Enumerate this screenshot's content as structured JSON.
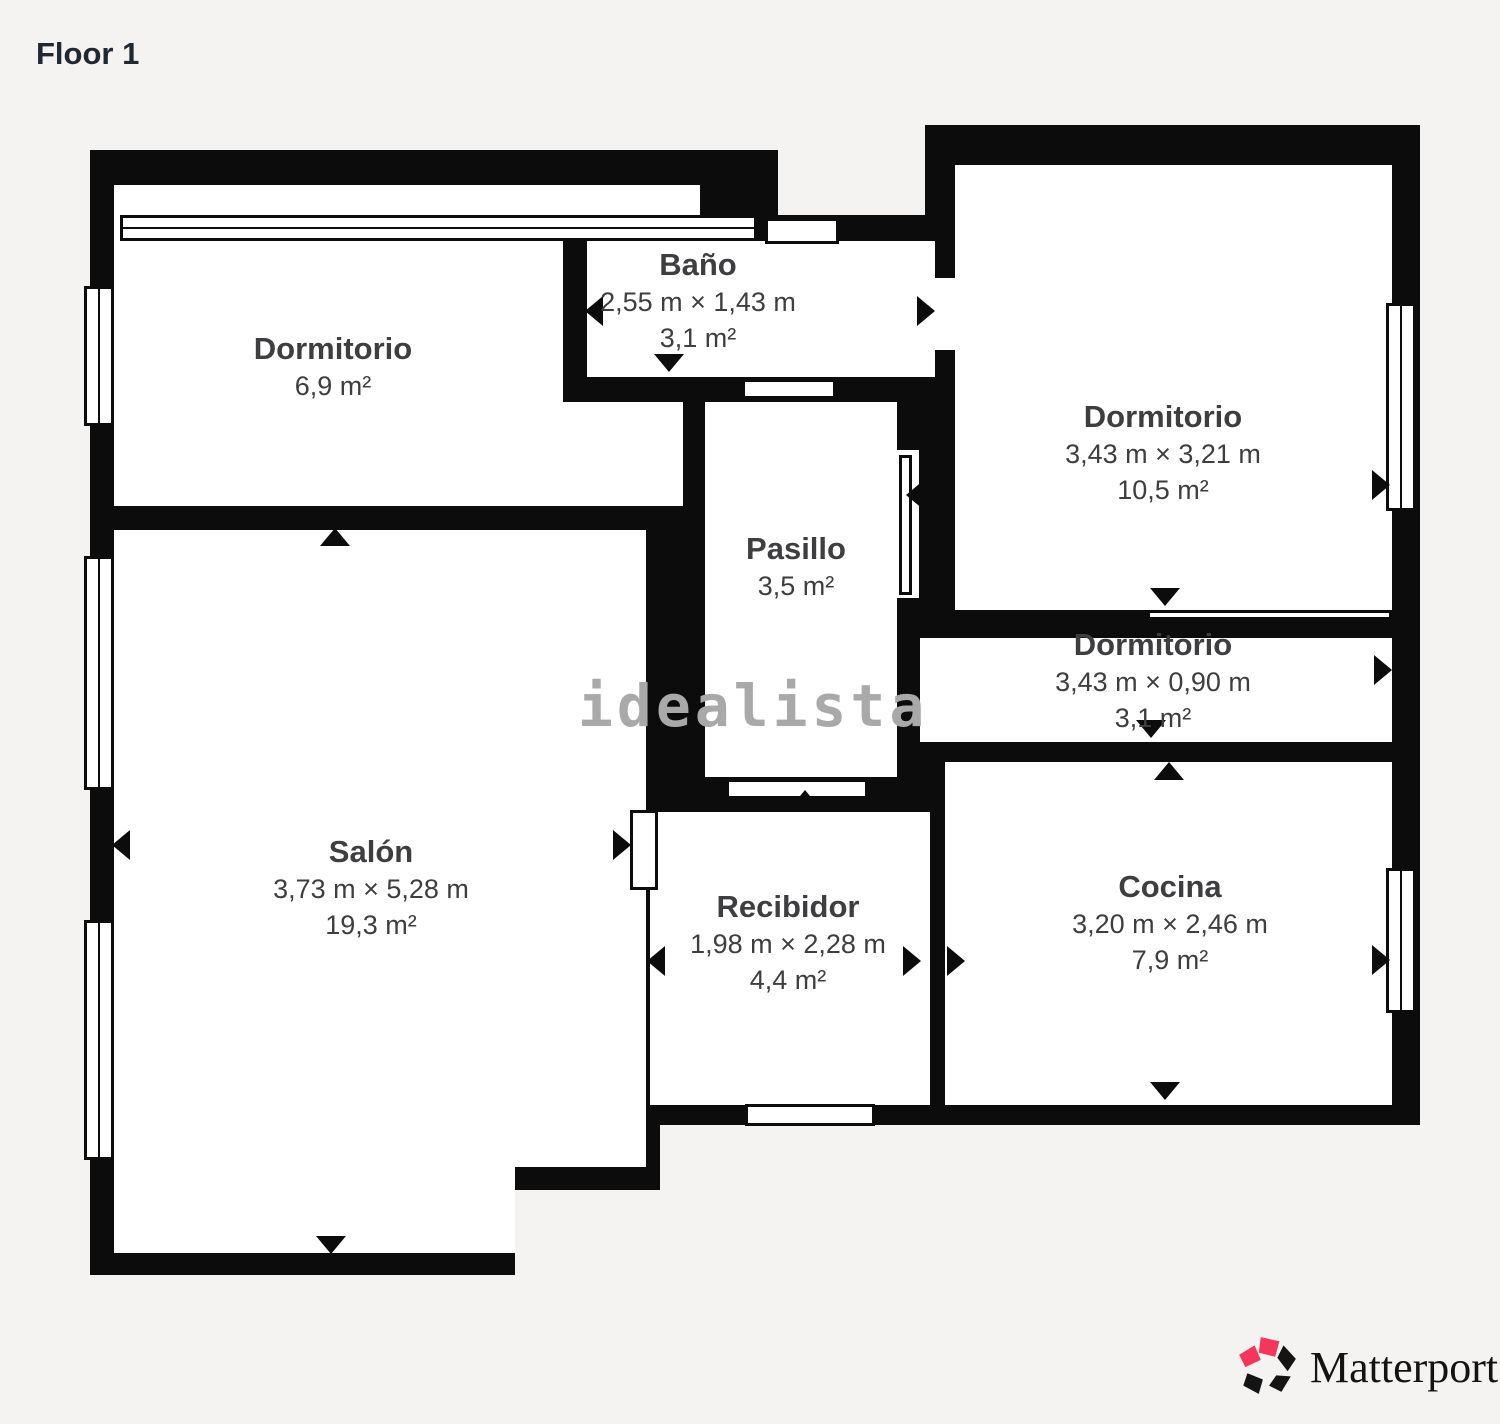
{
  "header": {
    "title": "Floor 1"
  },
  "watermark": {
    "text": "idealista",
    "color": "#a9a9a9"
  },
  "branding": {
    "logo_text": "Matterport",
    "icon": "matterport-pinwheel-icon",
    "logo_red": "#f4365c",
    "logo_black": "#141414"
  },
  "colors": {
    "background": "#f5f3f1",
    "wall": "#0c0c0c",
    "floor": "#ffffff",
    "label": "#3e3e40"
  },
  "rooms": [
    {
      "id": "dormitorio-top-left",
      "name": "Dormitorio",
      "dims": "",
      "area": "6,9 m²"
    },
    {
      "id": "bano",
      "name": "Baño",
      "dims": "2,55 m × 1,43 m",
      "area": "3,1 m²"
    },
    {
      "id": "dormitorio-top-right",
      "name": "Dormitorio",
      "dims": "3,43 m × 3,21 m",
      "area": "10,5 m²"
    },
    {
      "id": "pasillo",
      "name": "Pasillo",
      "dims": "",
      "area": "3,5 m²"
    },
    {
      "id": "dormitorio-middle",
      "name": "Dormitorio",
      "dims": "3,43 m × 0,90 m",
      "area": "3,1 m²"
    },
    {
      "id": "salon",
      "name": "Salón",
      "dims": "3,73 m × 5,28 m",
      "area": "19,3 m²"
    },
    {
      "id": "recibidor",
      "name": "Recibidor",
      "dims": "1,98 m × 2,28 m",
      "area": "4,4 m²"
    },
    {
      "id": "cocina",
      "name": "Cocina",
      "dims": "3,20 m × 2,46 m",
      "area": "7,9 m²"
    }
  ]
}
